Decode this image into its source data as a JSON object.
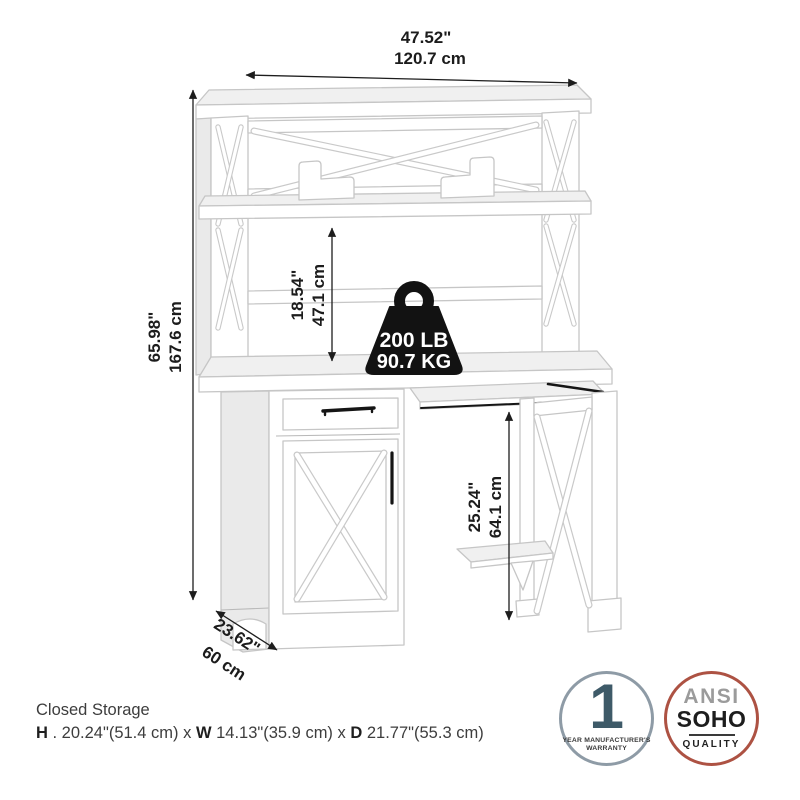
{
  "dimensions": {
    "width": {
      "inches": "47.52\"",
      "metric": "120.7 cm"
    },
    "height": {
      "inches": "65.98\"",
      "metric": "167.6 cm"
    },
    "hutch_opening": {
      "inches": "18.54\"",
      "metric": "47.1 cm"
    },
    "knee_space": {
      "inches": "25.24\"",
      "metric": "64.1 cm"
    },
    "depth": {
      "inches": "23.62\"",
      "metric": "60 cm"
    }
  },
  "weight_capacity": {
    "pounds": "200 LB",
    "kilograms": "90.7 KG"
  },
  "storage_spec": {
    "title": "Closed Storage",
    "h_label": "H",
    "h_value": " . 20.24\"(51.4 cm) x ",
    "w_label": "W",
    "w_value": " 14.13\"(35.9 cm) x ",
    "d_label": "D",
    "d_value": " 21.77\"(55.3 cm)"
  },
  "badges": {
    "warranty": {
      "number": "1",
      "caption_line1": "YEAR MANUFACTURER'S",
      "caption_line2": "WARRANTY",
      "ring_color": "#8e9ba6",
      "number_color": "#3e5a68"
    },
    "quality": {
      "org": "ANSI",
      "category": "SOHO",
      "label": "QUALITY",
      "ring_color": "#ad5243"
    }
  },
  "colors": {
    "background": "#ffffff",
    "line_art": "#c6c6c6",
    "annotation": "#1d1d1d",
    "weight_icon": "#121212"
  }
}
